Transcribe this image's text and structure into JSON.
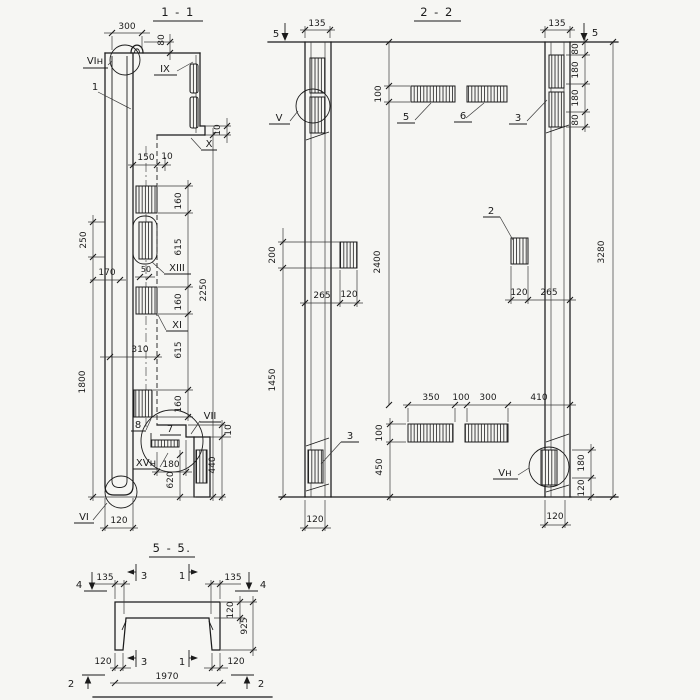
{
  "style": {
    "ink": "#1b1b1b",
    "paper": "#f6f6f3"
  },
  "section_1_1": {
    "title": "1 - 1",
    "dims": {
      "top_300": "300",
      "top_80": "80",
      "right_10_top": "10",
      "mid_150": "150",
      "mid_10": "10",
      "chain_160_a": "160",
      "chain_615_a": "615",
      "chain_160_b": "160",
      "chain_615_b": "615",
      "chain_160_c": "160",
      "overall_2250": "2250",
      "left_250": "250",
      "left_170": "170",
      "left_50": "50",
      "left_310": "310",
      "left_1800": "1800",
      "bot_180": "180",
      "bot_620": "620",
      "bot_440": "440",
      "bot_10": "10",
      "bot_120": "120"
    },
    "labels": {
      "vi_top": "VIн",
      "item_1": "1",
      "ix": "IX",
      "x": "X",
      "xiii": "XIII",
      "xi": "XI",
      "vii": "VII",
      "item_7": "7",
      "item_8": "8",
      "xv": "XVн",
      "vi_bot": "VI"
    }
  },
  "section_2_2": {
    "title": "2 - 2",
    "dims": {
      "top_135_l": "135",
      "top_135_r": "135",
      "stack_80_a": "80",
      "stack_180_a": "180",
      "stack_180_b": "180",
      "stack_80_b": "80",
      "top_100": "100",
      "left_200": "200",
      "left_1450": "1450",
      "mid_2400": "2400",
      "right_3280": "3280",
      "midrow_265_l": "265",
      "midrow_120_l": "120",
      "midrow_120_r": "120",
      "midrow_265_r": "265",
      "low_350": "350",
      "low_100": "100",
      "low_300": "300",
      "low_410": "410",
      "low_100_v": "100",
      "low_450": "450",
      "br_180": "180",
      "br_120": "120",
      "bot_120_l": "120",
      "bot_120_r": "120"
    },
    "labels": {
      "cut_5_l": "5",
      "cut_5_r": "5",
      "v_top": "V",
      "v_bot": "Vн",
      "item_5": "5",
      "item_6": "6",
      "item_3_top": "3",
      "item_3_bot": "3",
      "item_2": "2"
    }
  },
  "section_5_5": {
    "title": "5 - 5.",
    "dims": {
      "top_135_l": "135",
      "top_135_r": "135",
      "right_120": "120",
      "right_925": "925",
      "bot_120_l": "120",
      "bot_120_r": "120",
      "bot_1970": "1970"
    },
    "labels": {
      "cut_4_l": "4",
      "cut_4_r": "4",
      "cut_3_top": "3",
      "cut_1_top": "1",
      "cut_3_bot": "3",
      "cut_1_bot": "1",
      "cut_2_l": "2",
      "cut_2_r": "2"
    }
  }
}
